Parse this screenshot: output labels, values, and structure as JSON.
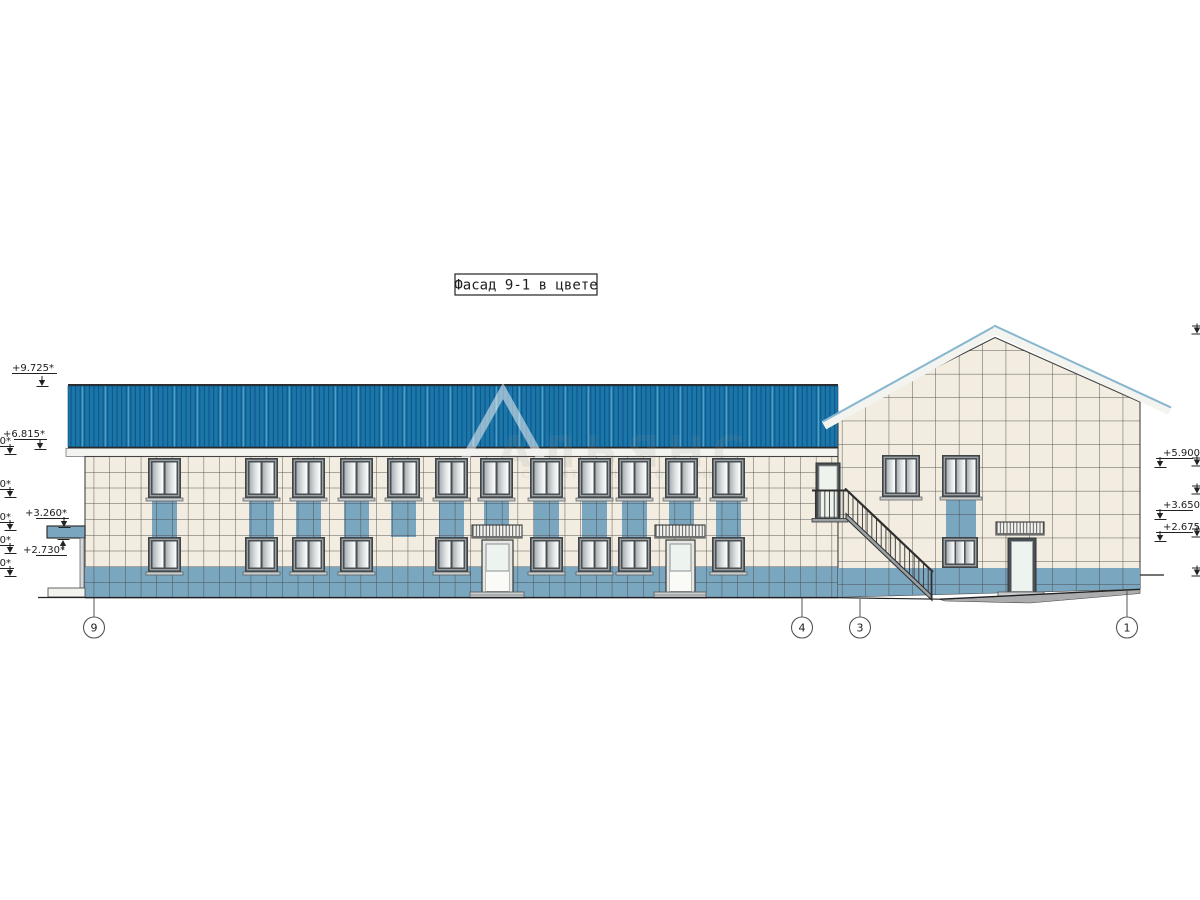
{
  "title": {
    "label": "Фасад 9-1 в цвете"
  },
  "watermark": {
    "logo": "alliance-triangle",
    "line1": "АЛЬЯНС",
    "line2": "СТРОИТЕЛЬНАЯ КОМПАНИЯ"
  },
  "levels_left": [
    {
      "label": "+9.725*"
    },
    {
      "label": "+6.815*"
    },
    {
      "label": "+3.260*"
    },
    {
      "label": "+2.730*"
    }
  ],
  "levels_left_clipped": [
    {
      "label": "40*"
    },
    {
      "label": "40*"
    },
    {
      "label": "10*"
    },
    {
      "label": "50*"
    },
    {
      "label": "40*"
    }
  ],
  "levels_right": [
    {
      "label": "+5.900*"
    },
    {
      "label": "+3.650*"
    },
    {
      "label": "+2.675*"
    }
  ],
  "axes": [
    {
      "label": "9"
    },
    {
      "label": "4"
    },
    {
      "label": "3"
    },
    {
      "label": "1"
    }
  ],
  "colors": {
    "roof_blue": "#1b76aa",
    "roof_stripe": "#0e598a",
    "roof_light": "#4f9fc6",
    "tile_cream": "#f2ede0",
    "tile_blue": "#7ba6bf",
    "trim_white": "#f3f3ef",
    "frame_gray": "#4a4f52",
    "line_dark": "#333333"
  }
}
